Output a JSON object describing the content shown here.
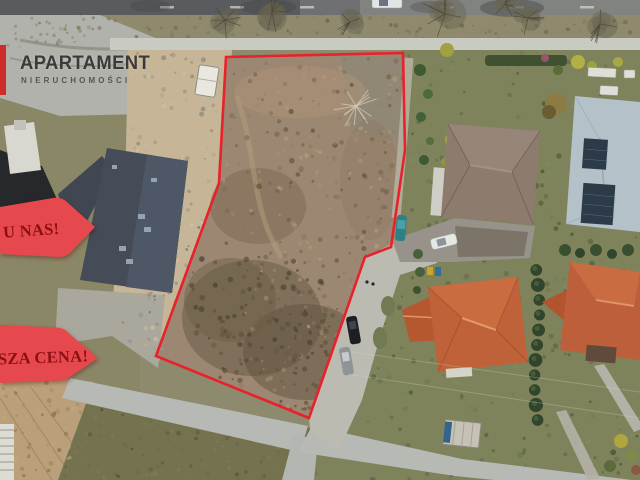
{
  "brand": {
    "name": "APARTAMENT",
    "subtitle": "NIERUCHOMOŚCI"
  },
  "banners": [
    {
      "label": "U NAS!"
    },
    {
      "label": "SZA CENA!"
    }
  ],
  "colors": {
    "plot_outline": "#e8212b",
    "banner_fill": "#e6494d",
    "banner_text": "#8c0f14",
    "logo_text": "#3a3a3a",
    "logo_square": "#cf2b2b"
  }
}
